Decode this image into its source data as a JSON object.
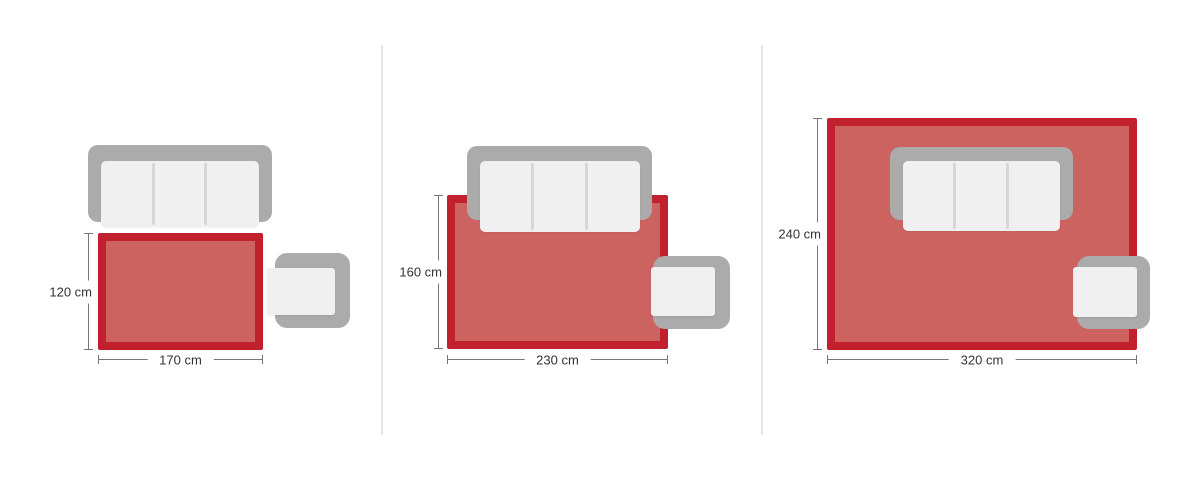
{
  "colors": {
    "rug_fill": "#cd6361",
    "rug_border": "#c1202d",
    "sofa_frame": "#ababab",
    "cushion": "#f0f0f0",
    "dimension_line": "#767676",
    "label_text": "#333333",
    "panel_divider": "#e4e4e4",
    "background": "#ffffff"
  },
  "panels": [
    {
      "name": "small",
      "rug_width_cm": 170,
      "rug_height_cm": 120,
      "width_label": "170 cm",
      "height_label": "120 cm"
    },
    {
      "name": "medium",
      "rug_width_cm": 230,
      "rug_height_cm": 160,
      "width_label": "230 cm",
      "height_label": "160 cm"
    },
    {
      "name": "large",
      "rug_width_cm": 320,
      "rug_height_cm": 240,
      "width_label": "320 cm",
      "height_label": "240 cm"
    }
  ]
}
